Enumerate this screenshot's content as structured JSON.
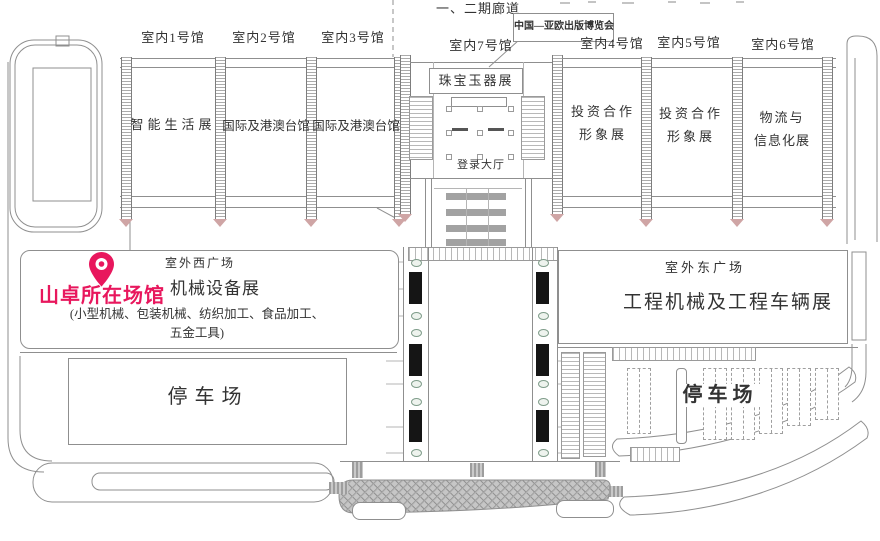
{
  "corridor": {
    "label": "一、二期廊道"
  },
  "expo_box": {
    "label": "中国—亚欧出版博览会"
  },
  "halls_west": [
    {
      "name": "室内1号馆",
      "content": "智能生活展"
    },
    {
      "name": "室内2号馆",
      "content": "国际及港澳台馆"
    },
    {
      "name": "室内3号馆",
      "content": "国际及港澳台馆"
    }
  ],
  "hall7": {
    "name": "室内7号馆",
    "exhibit": "珠宝玉器展",
    "lobby": "登录大厅"
  },
  "halls_east": [
    {
      "name": "室内4号馆",
      "line1": "投资合作",
      "line2": "形象展"
    },
    {
      "name": "室内5号馆",
      "line1": "投资合作",
      "line2": "形象展"
    },
    {
      "name": "室内6号馆",
      "line1": "物流与",
      "line2": "信息化展"
    }
  ],
  "west_plaza": {
    "label": "室外西广场",
    "pin_label": "山卓所在场馆",
    "exhibit": "机械设备展",
    "detail1": "(小型机械、包装机械、纺织加工、食品加工、",
    "detail2": "五金工具)"
  },
  "east_plaza": {
    "label": "室外东广场",
    "exhibit": "工程机械及工程车辆展"
  },
  "parking_west": {
    "label": "停车场"
  },
  "parking_east": {
    "label": "停车场"
  },
  "colors": {
    "pin_pink": "#e8175d",
    "line_gray": "#8f8f8f",
    "road_gray": "#c6c6c6"
  }
}
